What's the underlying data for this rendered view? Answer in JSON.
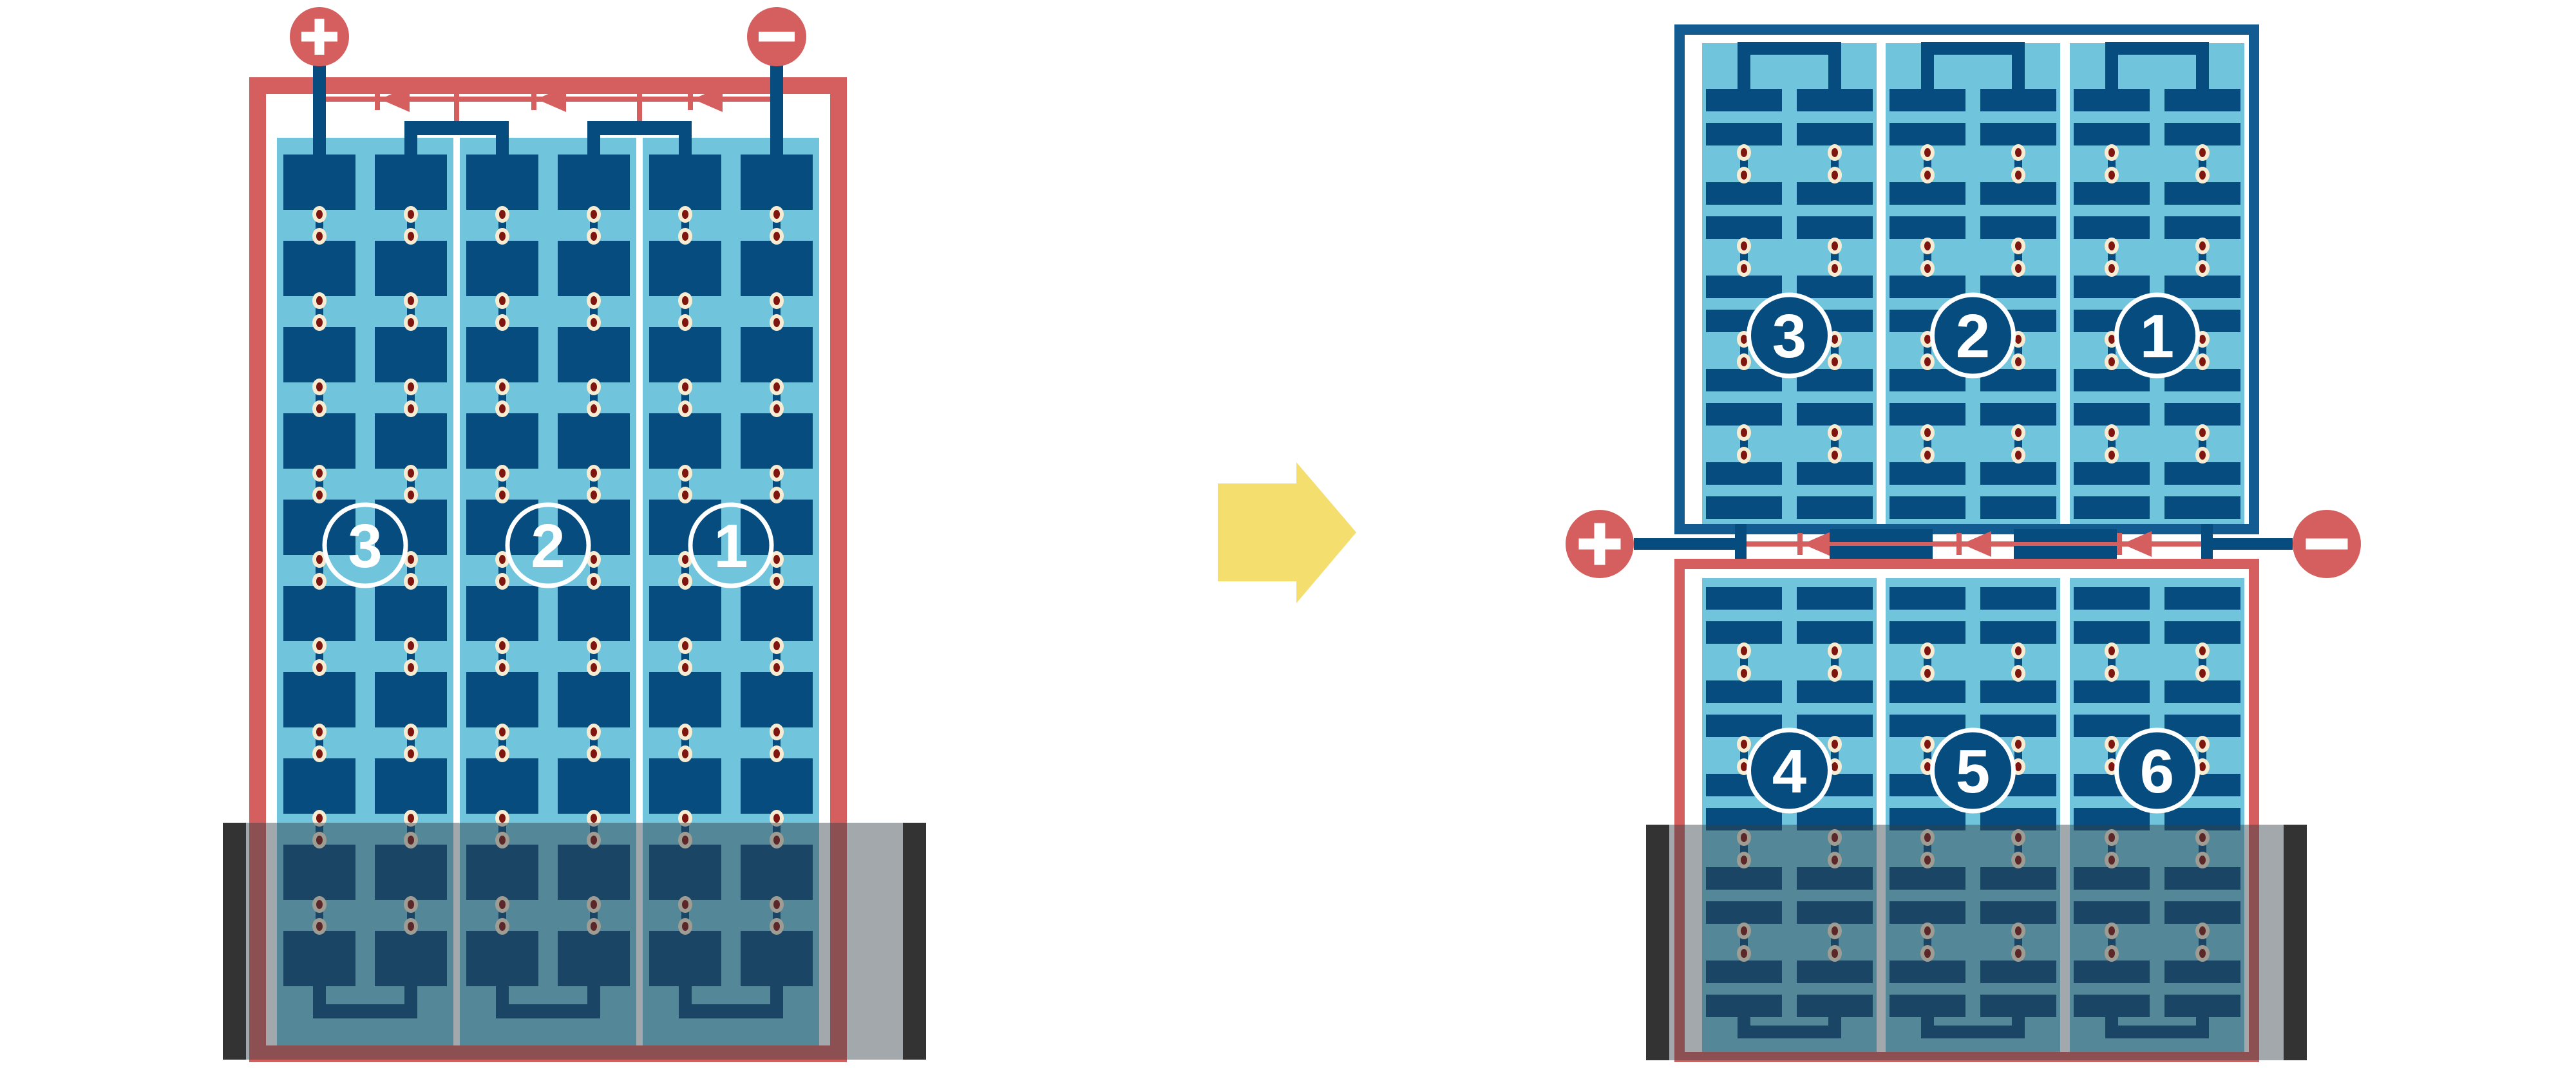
{
  "figure": {
    "description": "Comparison of a standard series-wired solar module and a half-cut-cell solar module under bottom-edge shading",
    "colors": {
      "background": "#FFFFFF",
      "red": "#D55F5E",
      "frame_blue": "#125C92",
      "cell_blue": "#074C7E",
      "light_blue": "#70C5DC",
      "solder_cream": "#F7ECD2",
      "solder_red": "#7E150F",
      "arrow_yellow": "#F3DE6E",
      "shade_bar": "#333333",
      "shade_overlay": "rgba(52,63,70,0.45)",
      "white": "#FFFFFF"
    },
    "left_panel": {
      "name": "full-cell-module",
      "terminal_positive": "+",
      "terminal_negative": "−",
      "string_labels": [
        "3",
        "2",
        "1"
      ],
      "strings": 3,
      "columns_per_string": 2,
      "cell_rows": 10,
      "bypass_diodes": 3,
      "shaded_bottom": true
    },
    "arrow": {
      "direction": "right"
    },
    "right_panel": {
      "name": "half-cut-module",
      "terminal_positive": "+",
      "terminal_negative": "−",
      "top_half_string_labels": [
        "3",
        "2",
        "1"
      ],
      "bottom_half_string_labels": [
        "4",
        "5",
        "6"
      ],
      "strings_per_half": 3,
      "cell_rows_per_half": 10,
      "bypass_diodes": 3,
      "shaded_bottom": true
    }
  }
}
